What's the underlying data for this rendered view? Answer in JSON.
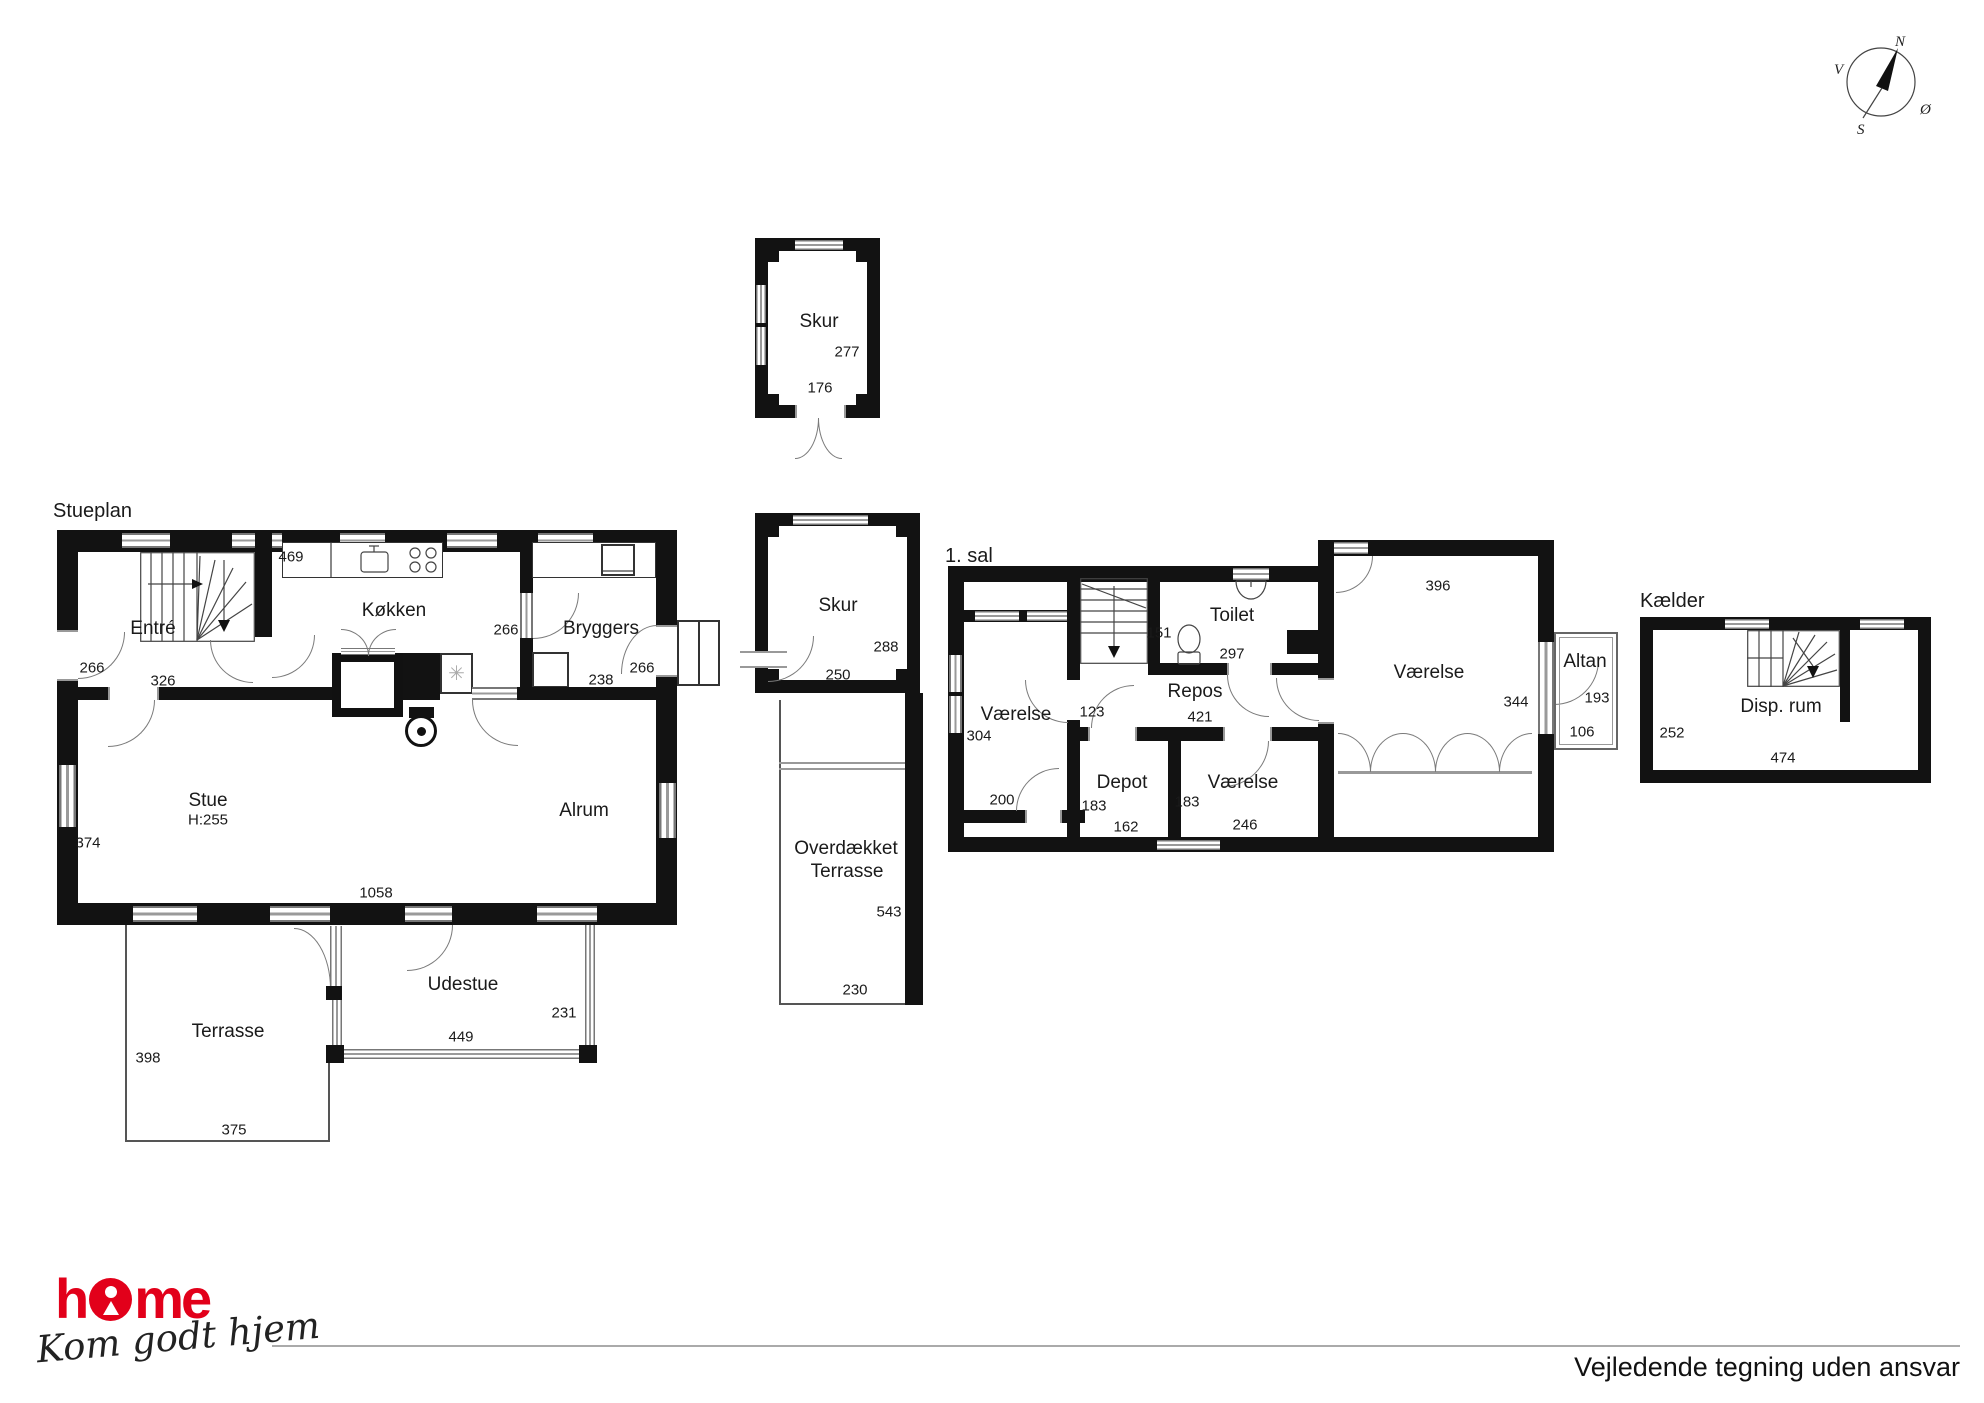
{
  "page": {
    "disclaimer": "Vejledende tegning uden ansvar"
  },
  "brand": {
    "name": "home",
    "tagline": "Kom godt hjem"
  },
  "compass": {
    "n": "N",
    "v": "V",
    "s": "S",
    "oe": "Ø"
  },
  "icons": {
    "freezer": "✳"
  },
  "plans": {
    "stueplan": {
      "title": "Stueplan",
      "rooms": {
        "entre": {
          "name": "Entré",
          "dim_door": "266",
          "dim_width": "326"
        },
        "koekken": {
          "name": "Køkken",
          "dim_top": "469",
          "dim_door": "266"
        },
        "bryggers": {
          "name": "Bryggers",
          "dim_width": "238",
          "dim_door": "266"
        },
        "stue": {
          "name": "Stue",
          "ceiling": "H:255",
          "dim_left": "374",
          "dim_bottom": "1058"
        },
        "alrum": {
          "name": "Alrum"
        },
        "udestue": {
          "name": "Udestue",
          "dim_bottom": "449",
          "dim_right": "231"
        },
        "terrasse": {
          "name": "Terrasse",
          "dim_left": "398",
          "dim_bottom": "375"
        }
      }
    },
    "skur_top": {
      "name": "Skur",
      "dim_height": "277",
      "dim_width": "176"
    },
    "skur_mid": {
      "name": "Skur",
      "dim_height": "288",
      "dim_width": "250"
    },
    "overdaekket": {
      "name_line1": "Overdækket",
      "name_line2": "Terrasse",
      "dim_height": "543",
      "dim_width": "230"
    },
    "sal1": {
      "title": "1. sal",
      "rooms": {
        "vaerelse_left": {
          "name": "Værelse",
          "dim_left": "304",
          "dim_door": "200"
        },
        "toilet": {
          "name": "Toilet",
          "dim_left": "151",
          "dim_width": "297"
        },
        "repos": {
          "name": "Repos",
          "dim_width": "421",
          "dim_left": "123"
        },
        "depot": {
          "name": "Depot",
          "dim_left": "183",
          "dim_width": "162"
        },
        "vaerelse_mid": {
          "name": "Værelse",
          "dim_left": "183",
          "dim_width": "246"
        },
        "vaerelse_big": {
          "name": "Værelse",
          "dim_top": "396",
          "dim_right": "344"
        },
        "altan": {
          "name": "Altan",
          "dim_height": "193",
          "dim_width": "106"
        }
      }
    },
    "kaelder": {
      "title": "Kælder",
      "rooms": {
        "disp": {
          "name": "Disp. rum",
          "dim_left": "252",
          "dim_bottom": "474"
        }
      }
    }
  }
}
